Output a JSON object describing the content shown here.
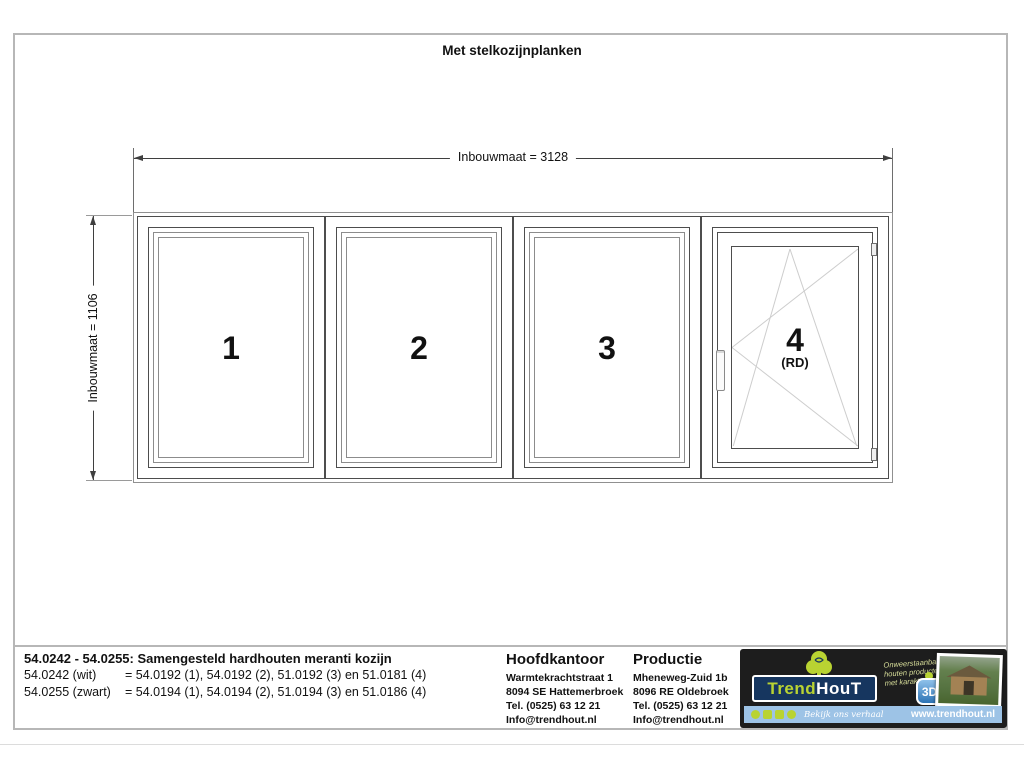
{
  "title": "Met stelkozijnplanken",
  "drawing": {
    "width_dim": "Inbouwmaat = 3128",
    "height_dim": "Inbouwmaat = 1106",
    "panels": [
      {
        "number": "1",
        "sub": ""
      },
      {
        "number": "2",
        "sub": ""
      },
      {
        "number": "3",
        "sub": ""
      },
      {
        "number": "4",
        "sub": "(RD)"
      }
    ]
  },
  "footer": {
    "product_title": "54.0242 - 54.0255: Samengesteld hardhouten meranti kozijn",
    "variants": [
      {
        "label": "54.0242 (wit)",
        "value": "= 54.0192 (1), 54.0192 (2), 51.0192 (3) en 51.0181 (4)"
      },
      {
        "label": "54.0255 (zwart)",
        "value": "= 54.0194 (1), 54.0194 (2), 51.0194 (3) en 51.0186 (4)"
      }
    ],
    "hoofdkantoor": {
      "heading": "Hoofdkantoor",
      "lines": [
        "Warmtekrachtstraat 1",
        "8094 SE Hattemerbroek",
        "Tel. (0525) 63 12 21",
        "Info@trendhout.nl"
      ]
    },
    "productie": {
      "heading": "Productie",
      "lines": [
        "Mheneweg-Zuid 1b",
        "8096 RE Oldebroek",
        "Tel. (0525) 63 12 21",
        "Info@trendhout.nl"
      ]
    },
    "brand": {
      "name_trend": "Trend",
      "name_hout": "HouT",
      "tagline_lines": [
        "Onweerstaanbare",
        "houten producten",
        "met karakter"
      ],
      "badge_label": "3D",
      "cta": "Bekijk ons verhaal",
      "website": "www.trendhout.nl"
    }
  },
  "colors": {
    "lime": "#b9d332",
    "logo_blue": "#16365f",
    "bar_blue": "#9dc3e6",
    "line_dark": "#4d4d4d",
    "line_light": "#8c8c8c"
  }
}
